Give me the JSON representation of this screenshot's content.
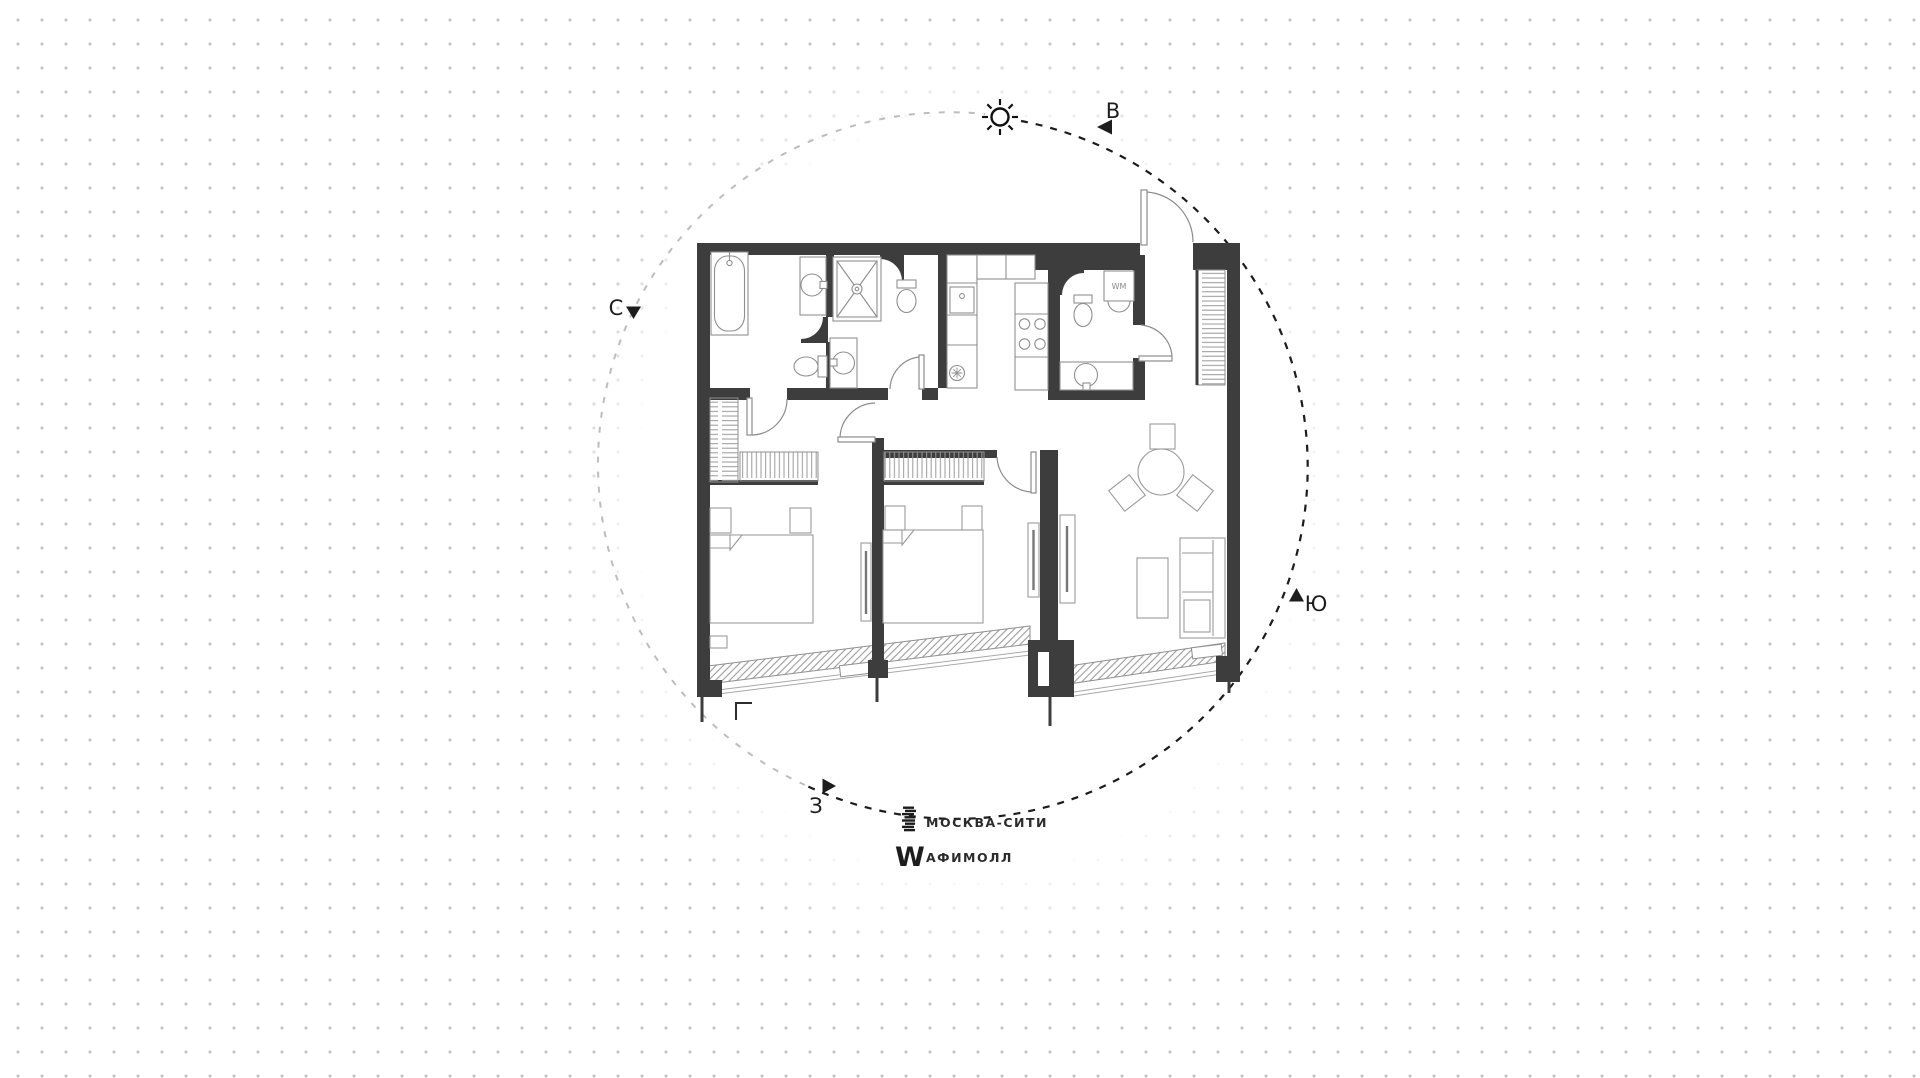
{
  "title": "apartment-floor-plan",
  "compass": {
    "north": "С",
    "east": "В",
    "south": "Ю",
    "west": "З"
  },
  "appliance_labels": {
    "washing_machine": "WM"
  },
  "legend": {
    "items": [
      {
        "icon": "moscow-city-tower-icon",
        "label": "МОСКВА-СИТИ"
      },
      {
        "icon": "afimall-w-icon",
        "label": "АФИМОЛЛ"
      }
    ]
  },
  "colors": {
    "wall": "#3d3d3d",
    "fixture_outline": "#8f8f8f",
    "furniture_outline": "#9a9a9a",
    "hatch": "#9b9b9b",
    "dashed_arc_dark": "#1c1c1c",
    "dashed_arc_light": "#bdbdbd",
    "dot": "#c5c5c5",
    "text": "#1d1d1d"
  }
}
